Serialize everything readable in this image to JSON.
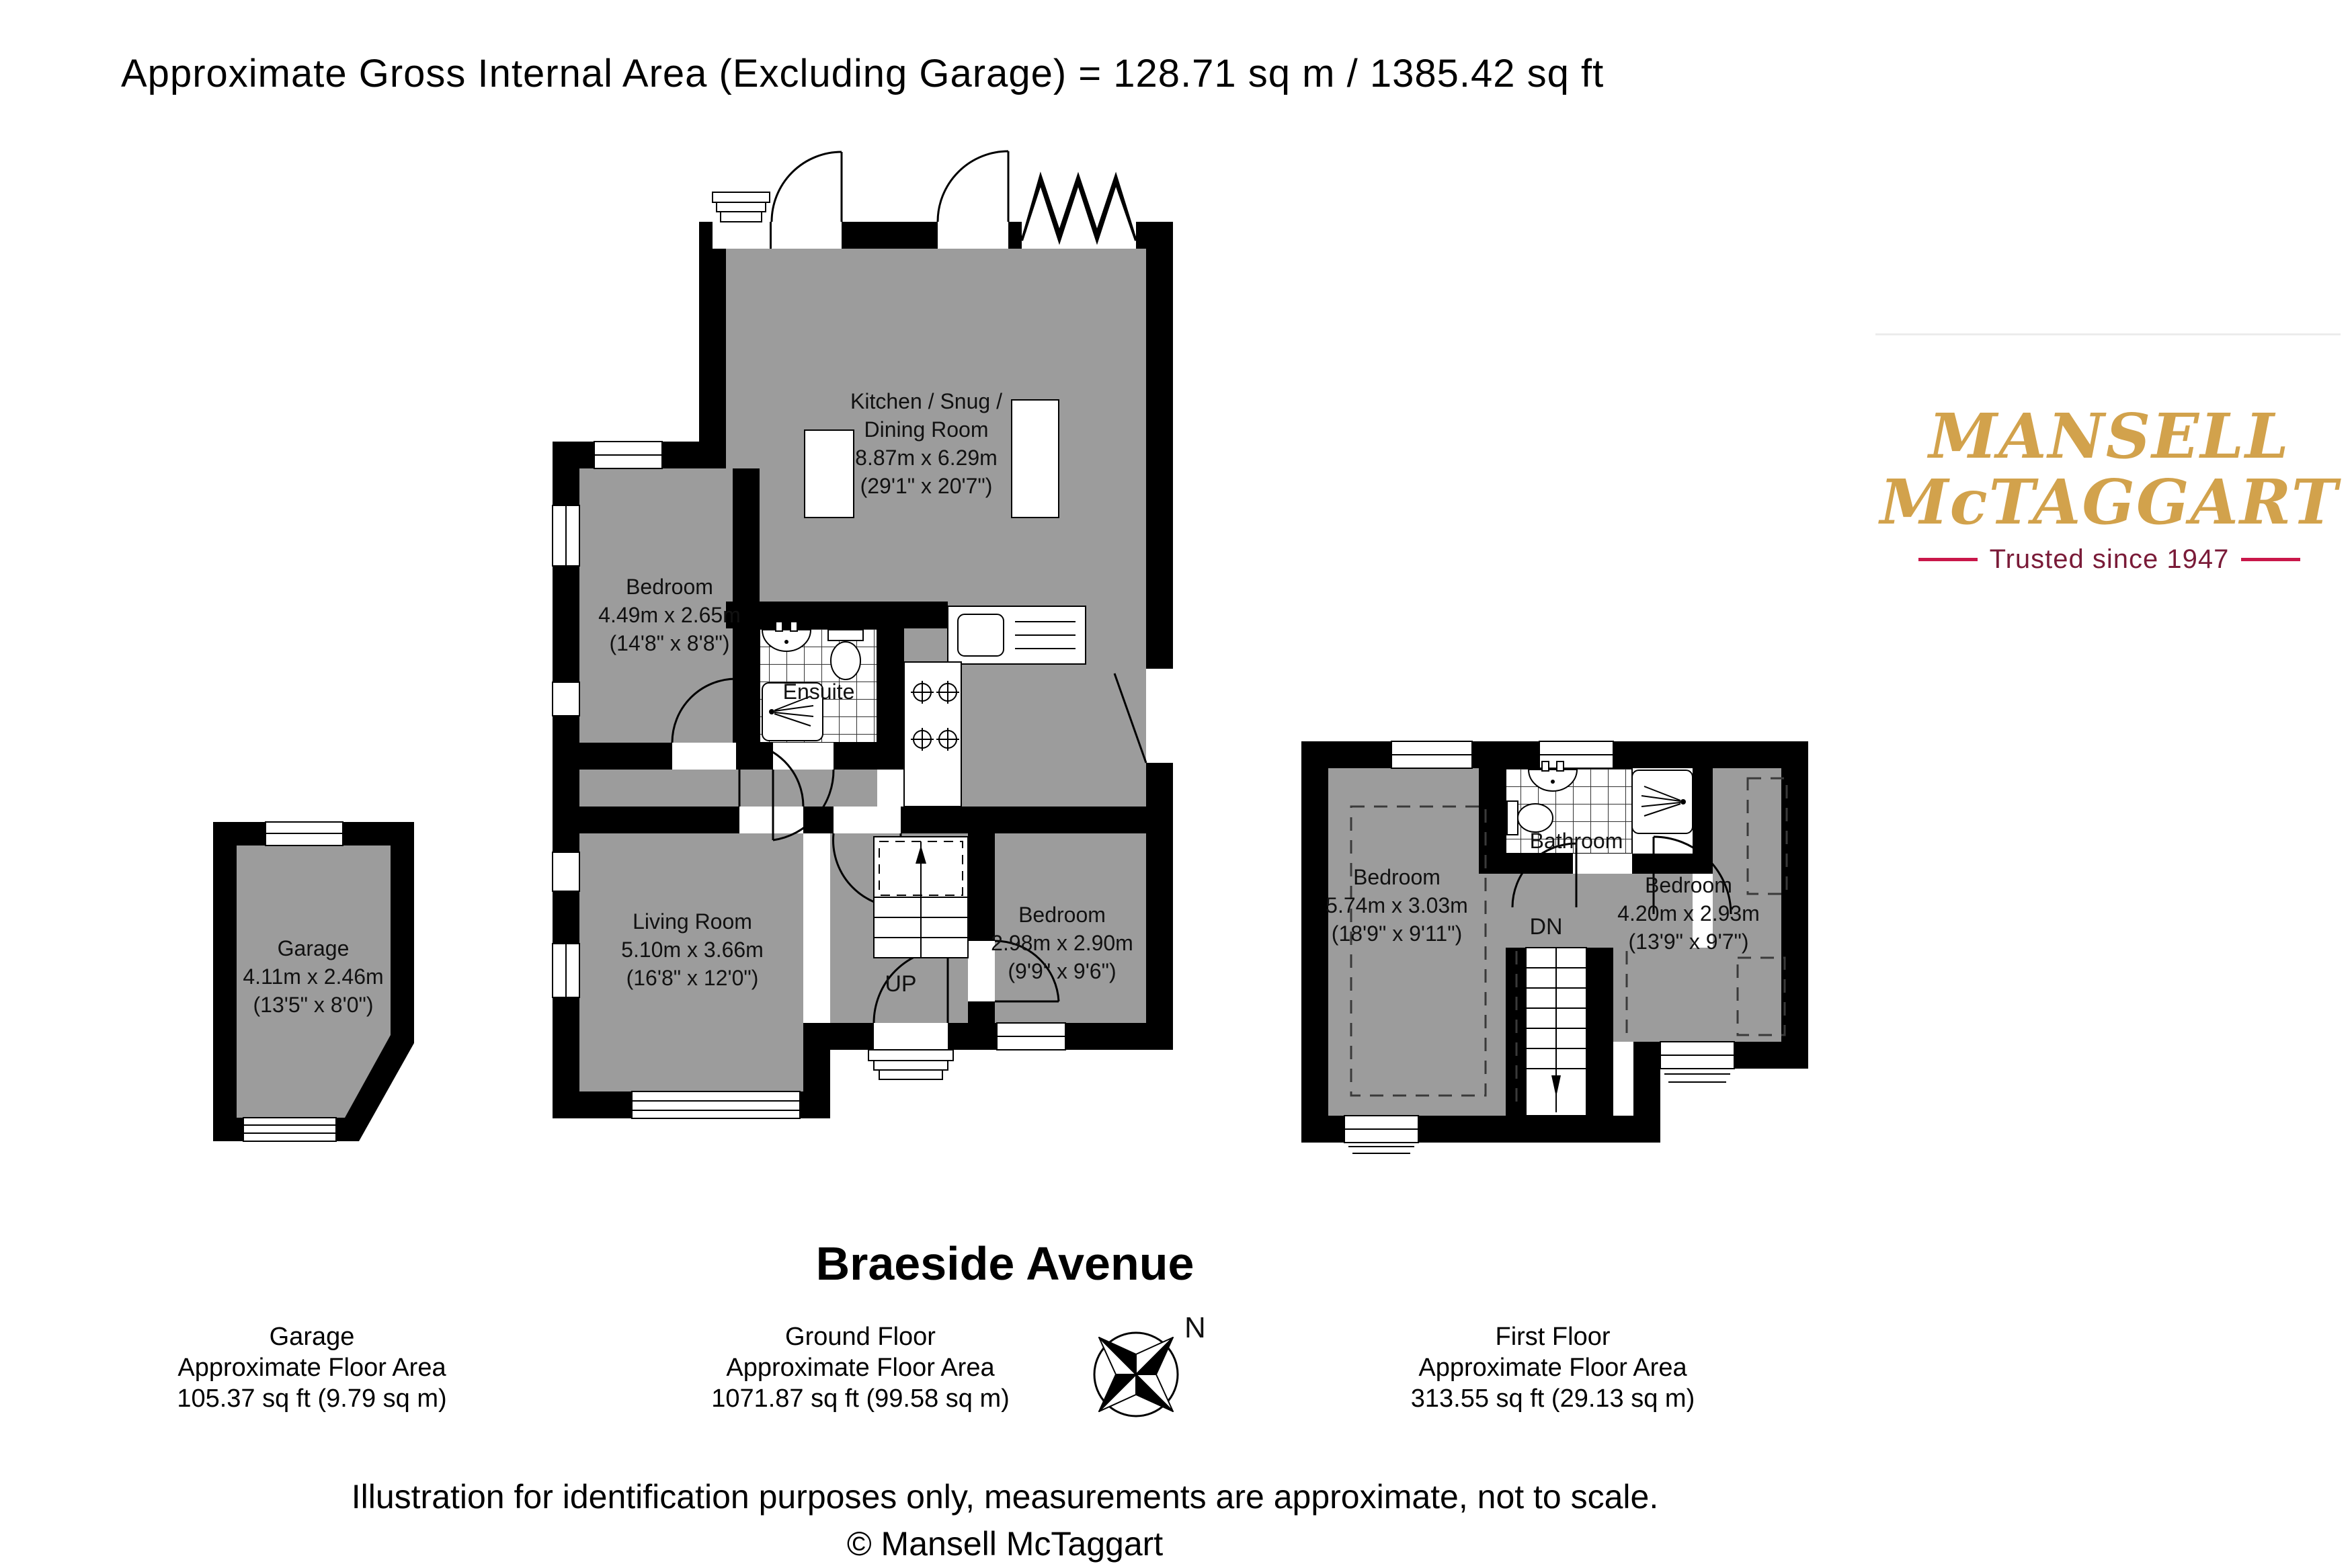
{
  "header": {
    "title": "Approximate Gross Internal Area (Excluding Garage) = 128.71 sq m / 1385.42 sq ft"
  },
  "logo": {
    "name_line1": "MANSELL",
    "name_line2": "McTAGGART",
    "tagline": "Trusted since 1947",
    "gold": "#D2A24C",
    "maroon": "#7A1B38",
    "accent": "#C9174A"
  },
  "plan": {
    "wall_color": "#000000",
    "floor_color": "#9C9C9C",
    "ground_floor": {
      "kitchen": {
        "name_line1": "Kitchen / Snug /",
        "name_line2": "Dining Room",
        "metric": "8.87m x 6.29m",
        "imperial": "(29'1\" x 20'7\")"
      },
      "bedroom_front": {
        "name": "Bedroom",
        "metric": "4.49m x 2.65m",
        "imperial": "(14'8\" x 8'8\")"
      },
      "ensuite": {
        "name": "Ensuite"
      },
      "living_room": {
        "name": "Living Room",
        "metric": "5.10m x 3.66m",
        "imperial": "(16'8\" x 12'0\")"
      },
      "bedroom_rear": {
        "name": "Bedroom",
        "metric": "2.98m x 2.90m",
        "imperial": "(9'9\" x 9'6\")"
      },
      "stairs": {
        "label": "UP"
      }
    },
    "garage": {
      "name": "Garage",
      "metric": "4.11m x 2.46m",
      "imperial": "(13'5\" x 8'0\")"
    },
    "first_floor": {
      "bedroom_left": {
        "name": "Bedroom",
        "metric": "5.74m x 3.03m",
        "imperial": "(18'9\" x 9'11\")"
      },
      "bedroom_right": {
        "name": "Bedroom",
        "metric": "4.20m x 2.93m",
        "imperial": "(13'9\" x 9'7\")"
      },
      "bathroom": {
        "name": "Bathroom"
      },
      "stairs": {
        "label": "DN"
      }
    },
    "compass": {
      "north_label": "N"
    }
  },
  "footer": {
    "address_title": "Braeside Avenue",
    "columns": [
      {
        "title": "Garage",
        "subtitle": "Approximate Floor Area",
        "area": "105.37 sq ft (9.79 sq m)"
      },
      {
        "title": "Ground Floor",
        "subtitle": "Approximate Floor Area",
        "area": "1071.87 sq ft (99.58 sq m)"
      },
      {
        "title": "First Floor",
        "subtitle": "Approximate Floor Area",
        "area": "313.55 sq ft (29.13 sq m)"
      }
    ],
    "disclaimer": "Illustration for identification purposes only, measurements are approximate, not to scale.",
    "copyright": "© Mansell McTaggart"
  }
}
